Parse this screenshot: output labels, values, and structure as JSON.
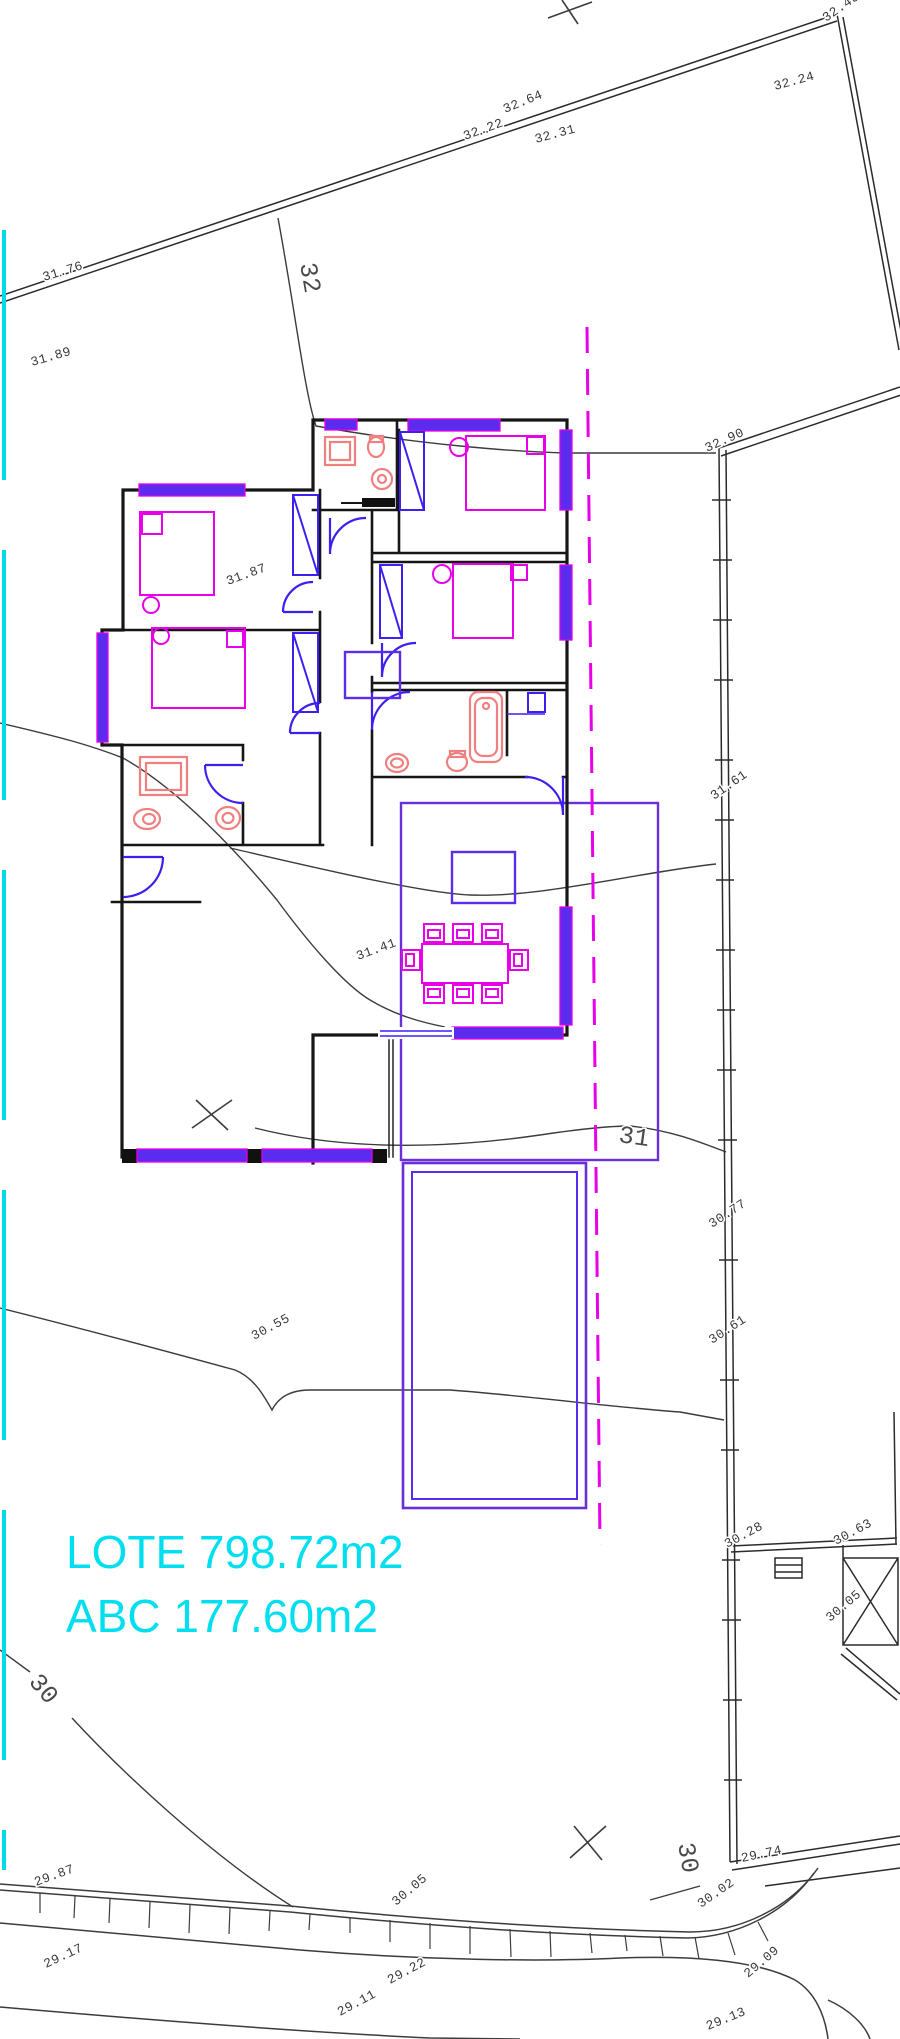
{
  "drawing": {
    "area_labels": {
      "lote": "LOTE 798.72m2",
      "abc": "ABC 177.60m2"
    },
    "contour_labels": {
      "c32": "32",
      "c31": "31",
      "c30_left": "30",
      "c30_right": "30"
    },
    "spot_elevations": {
      "e31_76": "31.76",
      "e31_89": "31.89",
      "e32_22": "32.22",
      "e32_64": "32.64",
      "e32_31": "32.31",
      "e32_24": "32.24",
      "e32_43": "32.43",
      "e32_90": "32.90",
      "e31_61": "31.61",
      "e31_87": "31.87",
      "e31_41": "31.41",
      "e30_77": "30.77",
      "e30_61": "30.61",
      "e30_55": "30.55",
      "e30_28": "30.28",
      "e30_63": "30.63",
      "e30_05_east": "30.05",
      "e29_74": "29.74",
      "e30_02": "30.02",
      "e29_09": "29.09",
      "e29_13": "29.13",
      "e29_87": "29.87",
      "e30_05_south": "30.05",
      "e29_17": "29.17",
      "e29_11": "29.11",
      "e29_22": "29.22"
    },
    "colors": {
      "boundary": "#2b2b2b",
      "contour": "#3c3c3c",
      "wall": "#161616",
      "window_fill": "#5b2bee",
      "window_edge": "#e800e8",
      "door_blue": "#3c20f0",
      "furniture_magenta": "#e800e8",
      "fixture_red": "#f08080",
      "pool_purple": "#6a2fd8",
      "axis_magenta": "#e800e8",
      "lot_cyan": "#00dff0"
    }
  }
}
